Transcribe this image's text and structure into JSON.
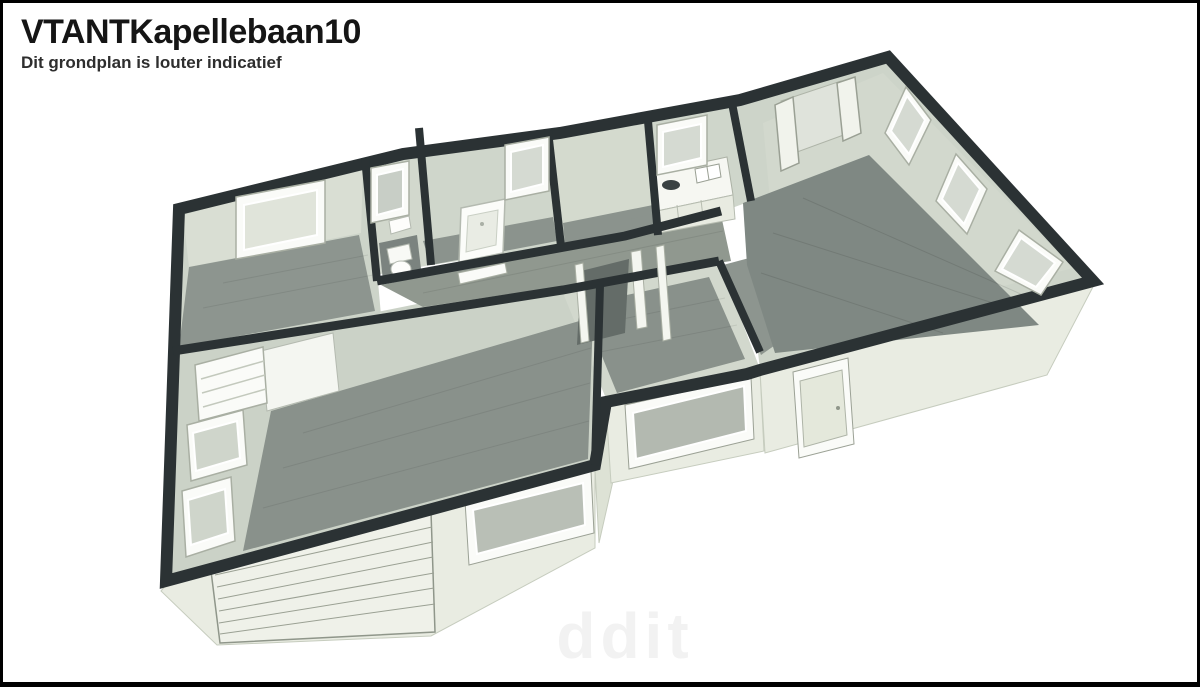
{
  "header": {
    "title": "VTANTKapellebaan10",
    "subtitle": "Dit grondplan is louter indicatief"
  },
  "watermark": {
    "text": "ddit"
  },
  "floorplan": {
    "view": "3D axonometric floor plan without roof",
    "palette": {
      "background": "#ffffff",
      "frame_border": "#000000",
      "wall_top": "#2b3234",
      "wall_face": "#cdd4c9",
      "wall_face_light": "#d9ded3",
      "exterior_face": "#e9ece2",
      "floor_gray": "#8d958f",
      "floor_dark": "#7f8883",
      "window_frame": "#fafbf8",
      "window_glass": "#dce1d7",
      "fixture_white": "#f8f9f5",
      "title_text": "#151515",
      "subtitle_text": "#2e2e2e",
      "watermark_text": "#f2f2f2"
    },
    "fixtures": [
      "garage-door",
      "long-window",
      "exterior-door",
      "bathtub",
      "toilet",
      "kitchen-counter",
      "kitchen-sink",
      "cooktop",
      "open-double-doors",
      "bedroom-window",
      "toilet-window",
      "bathroom-window",
      "kitchen-window",
      "living-room-windows",
      "side-wall-windows",
      "interior-door"
    ]
  }
}
